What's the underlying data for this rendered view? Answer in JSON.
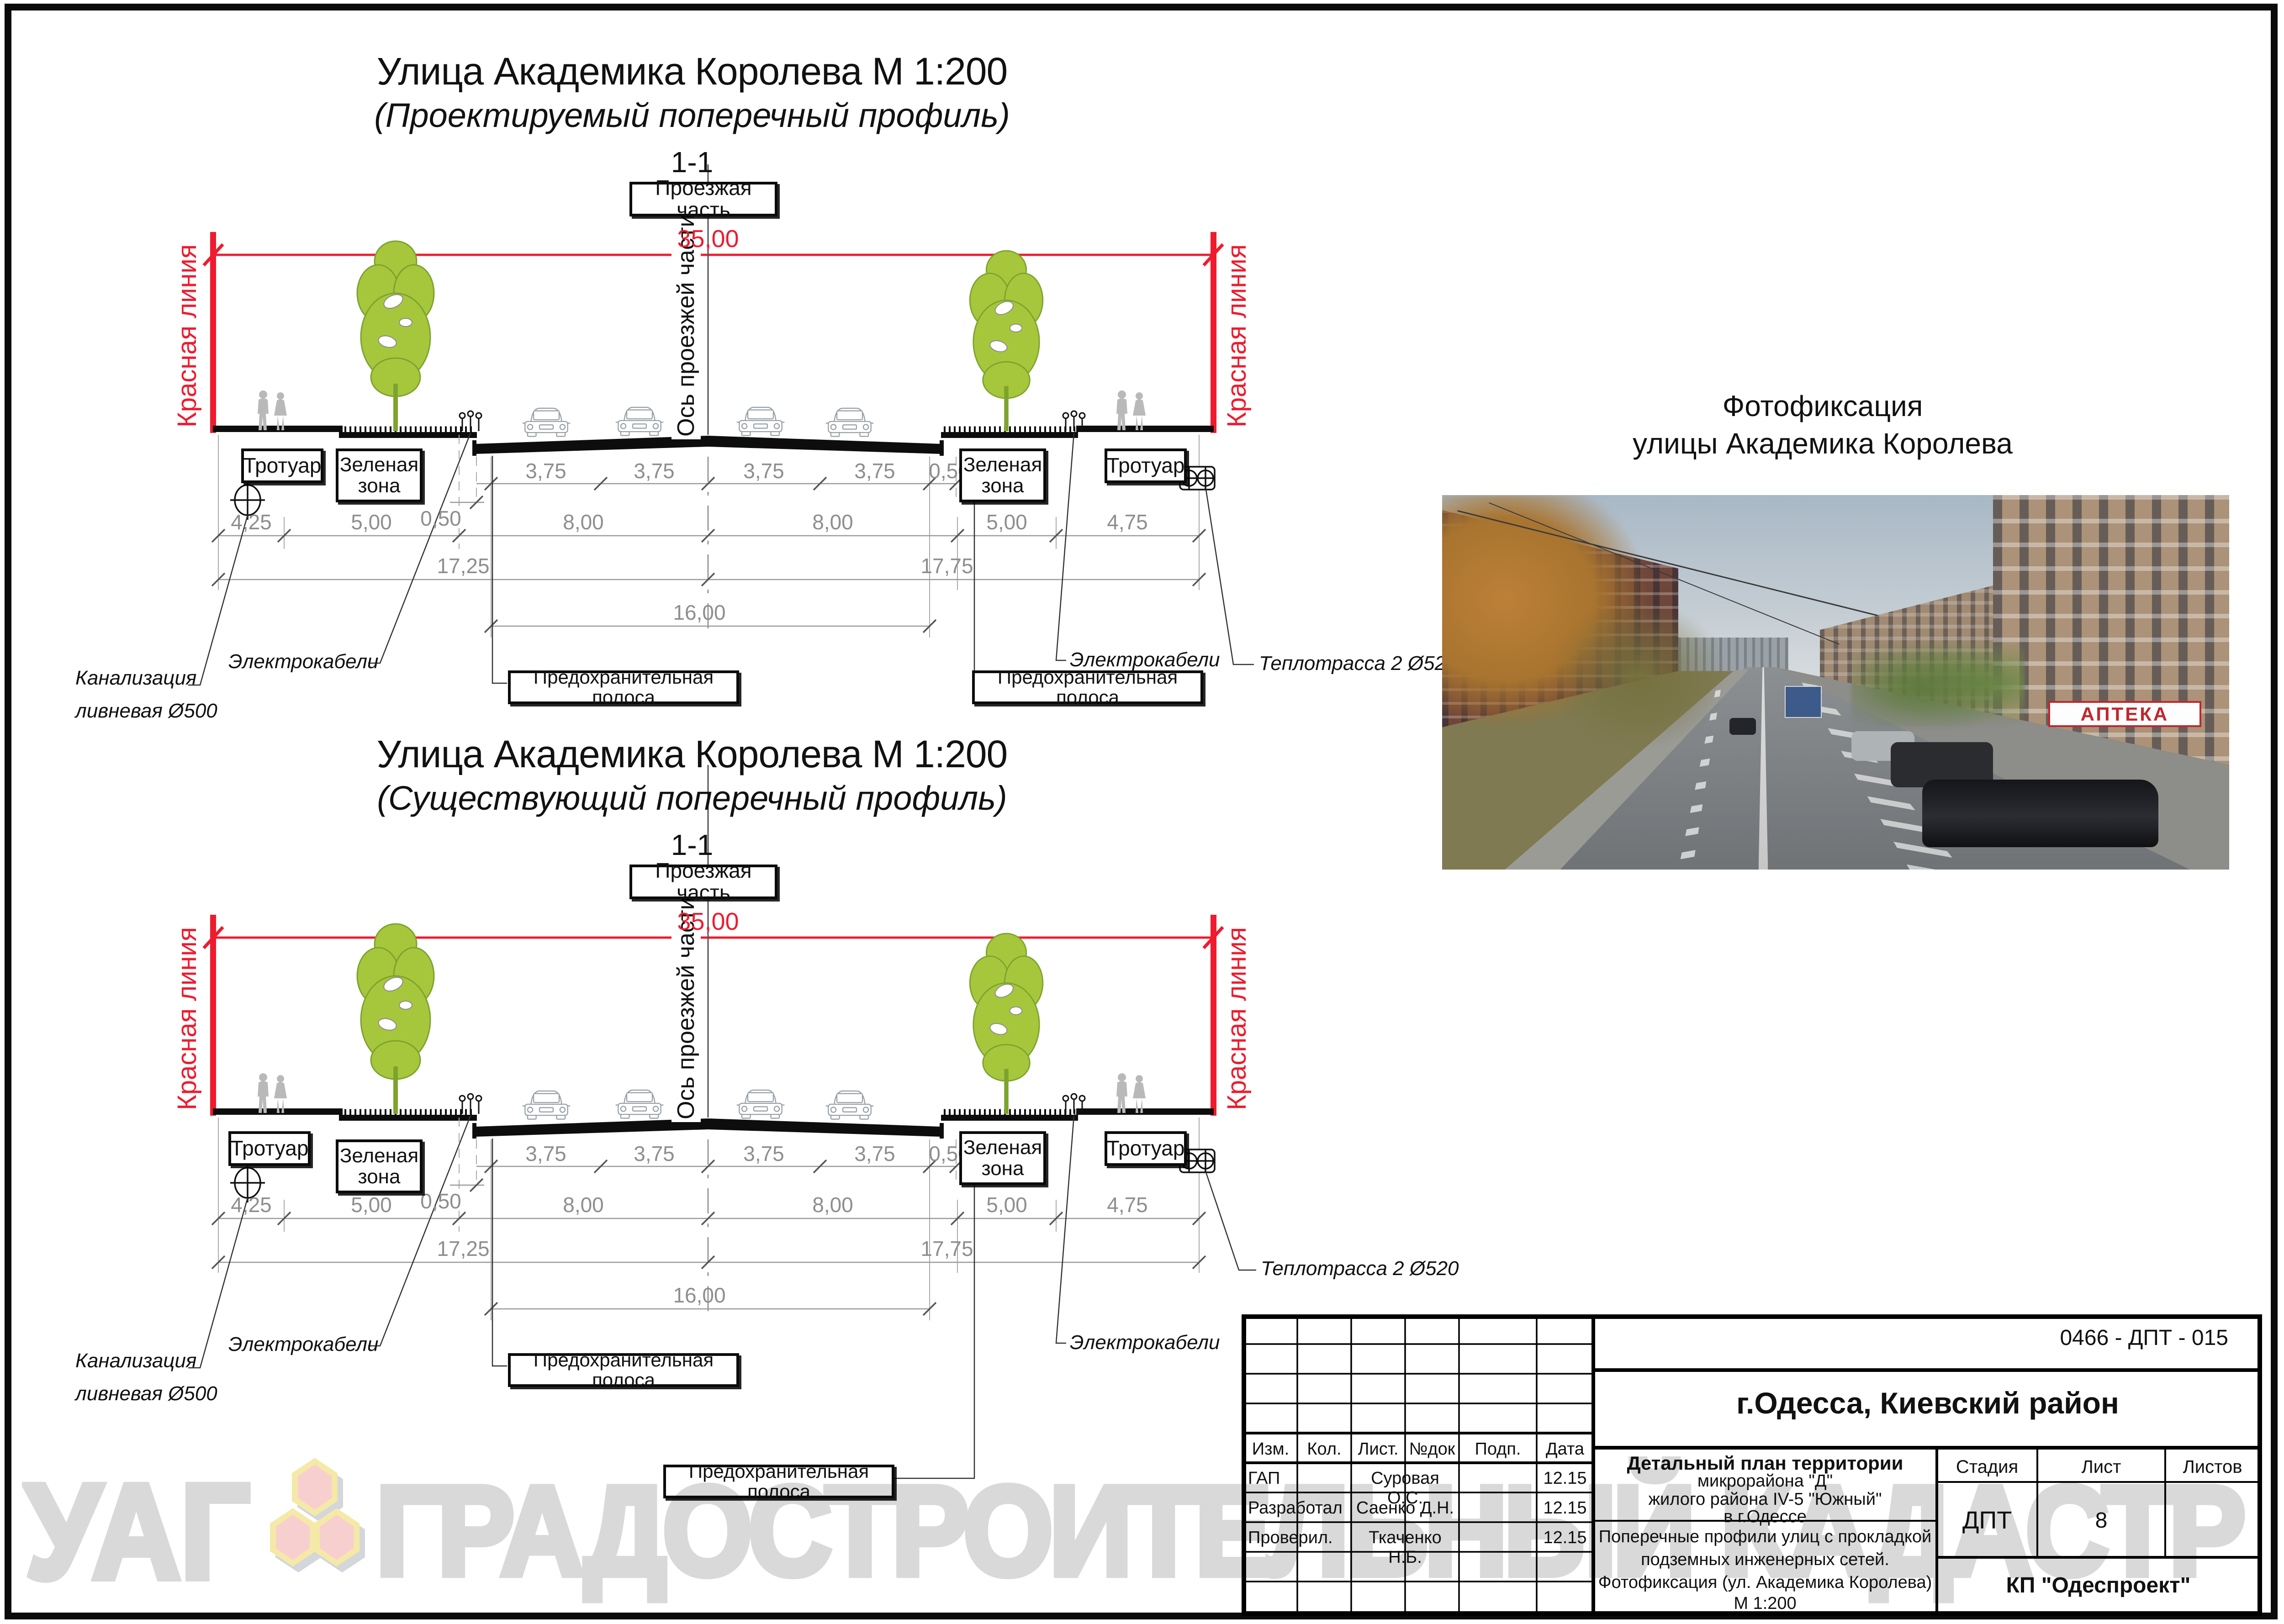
{
  "profiles": [
    {
      "title": "Улица Академика Королева М 1:200",
      "subtitle": "(Проектируемый поперечный профиль)",
      "section_mark": "1-1",
      "roadway_label": "Проезжая часть"
    },
    {
      "title": "Улица Академика Королева М 1:200",
      "subtitle": "(Существующий поперечный профиль)",
      "section_mark": "1-1",
      "roadway_label": "Проезжая часть"
    }
  ],
  "labels": {
    "red_line": "Красная линия",
    "axis": "Ось проезжей части",
    "sidewalk": "Тротуар",
    "green_zone": "Зеленая зона",
    "guard_strip": "Предохранительная полоса",
    "cables": "Электрокабели",
    "sewer_line1": "Канализация",
    "sewer_line2": "ливневая Ø500",
    "heat_main": "Теплотрасса 2 Ø520"
  },
  "dims": {
    "total": "35,00",
    "lanes": [
      "3,75",
      "3,75",
      "3,75",
      "3,75"
    ],
    "edge": "0,50",
    "row2": [
      "4,25",
      "5,00",
      "8,00",
      "8,00",
      "5,00",
      "4,75"
    ],
    "half_left": "17,25",
    "half_right": "17,75",
    "carriageway": "16,00"
  },
  "photo": {
    "caption_line1": "Фотофиксация",
    "caption_line2": "улицы  Академика Королева",
    "pharmacy_sign": "АПТЕКА"
  },
  "title_block": {
    "doc_number": "0466 - ДПТ - 015",
    "city": "г.Одесса, Киевский район",
    "cols": [
      "Изм.",
      "Кол.",
      "Лист.",
      "№док",
      "Подп.",
      "Дата"
    ],
    "rows": [
      {
        "role": "ГАП",
        "name": "Суровая О.С.",
        "date": "12.15"
      },
      {
        "role": "Разработал",
        "name": "Саенко Д.Н.",
        "date": "12.15"
      },
      {
        "role": "Проверил.",
        "name": "Ткаченко Н.Б.",
        "date": "12.15"
      }
    ],
    "project_line1": "Детальный план территории",
    "project_line2": "микрорайона \"Д\"",
    "project_line3": "жилого района IV-5 \"Южный\"",
    "project_line4": "в г.Одессе",
    "sheet_title_line1": "Поперечные профили улиц с прокладкой",
    "sheet_title_line2": "подземных инженерных сетей.",
    "sheet_title_line3": "Фотофиксация  (ул. Академика Королева)",
    "sheet_title_line4": "М 1:200",
    "stage_label": "Стадия",
    "sheet_label": "Лист",
    "sheets_label": "Листов",
    "stage": "ДПТ",
    "sheet_no": "8",
    "org": "КП \"Одеспроект\""
  },
  "watermark": {
    "part1": "УАГ",
    "part2": "ГРАДОСТРОИТЕЛЬНЫЙ КАДАСТР"
  },
  "colors": {
    "red": "#ee1c2e",
    "tree": "#a6c73c",
    "dim_gray": "#8e8e8e",
    "watermark": "#d9d9d9"
  }
}
